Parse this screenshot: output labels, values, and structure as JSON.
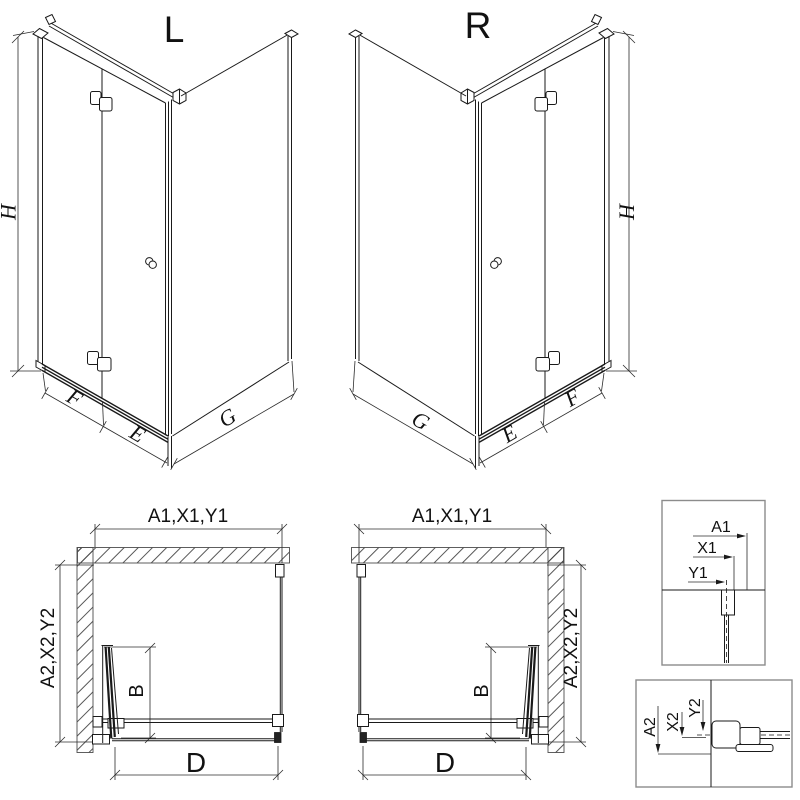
{
  "colors": {
    "line": "#1a1a1a",
    "box_border": "#8c8c8c",
    "hatch": "#444444",
    "background": "#ffffff"
  },
  "iso_left": {
    "label": "L",
    "dim_h": "H",
    "dim_f": "F",
    "dim_e": "E",
    "dim_g": "G"
  },
  "iso_right": {
    "label": "R",
    "dim_h": "H",
    "dim_f": "F",
    "dim_e": "E",
    "dim_g": "G"
  },
  "plan_left": {
    "dim_top": "A1,X1,Y1",
    "dim_side": "A2,X2,Y2",
    "dim_b": "B",
    "dim_d": "D"
  },
  "plan_right": {
    "dim_top": "A1,X1,Y1",
    "dim_side": "A2,X2,Y2",
    "dim_b": "B",
    "dim_d": "D"
  },
  "detail_a1": {
    "dim_a1": "A1",
    "dim_x1": "X1",
    "dim_y1": "Y1"
  },
  "detail_a2": {
    "dim_a2": "A2",
    "dim_x2": "X2",
    "dim_y2": "Y2"
  }
}
